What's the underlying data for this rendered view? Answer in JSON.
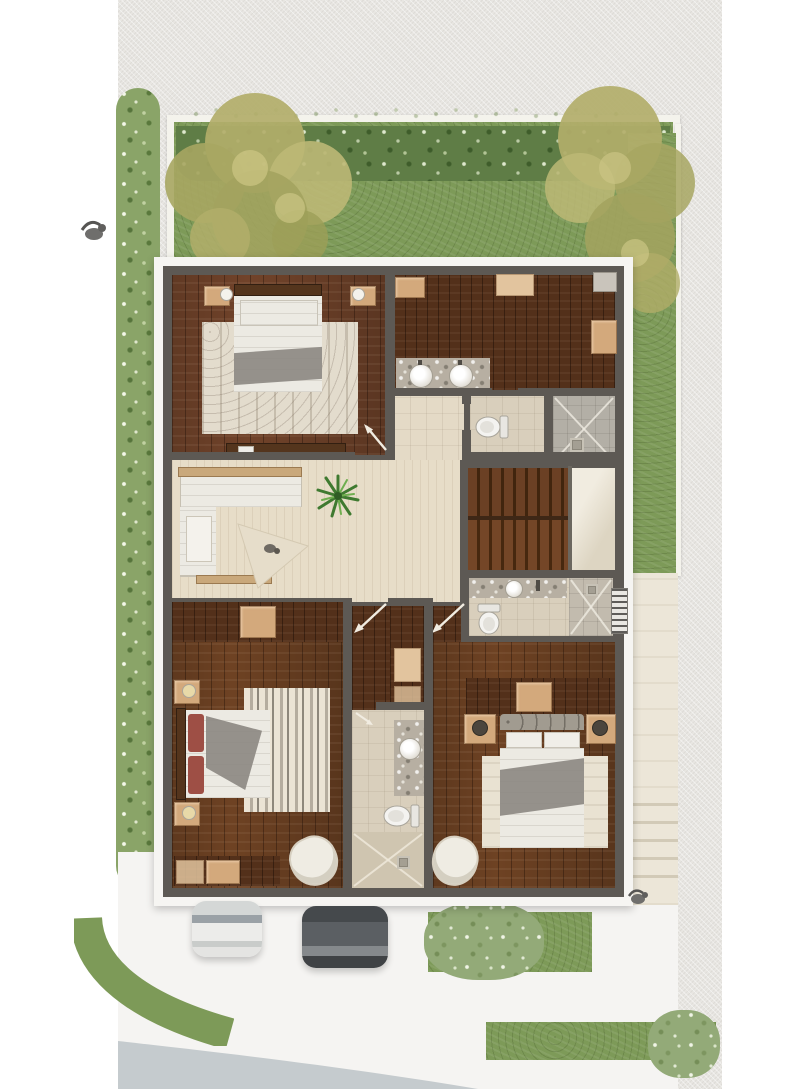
{
  "scene_type": "architectural-floor-plan-render-top-view",
  "visible_text": [],
  "colors": {
    "page_bg": "#ffffff",
    "ground": "#e8e6e2",
    "sidewalk": "#f5f4f2",
    "street": "#c5cbce",
    "lawn": "#7d9a58",
    "shrub_dark": "#5f7d46",
    "shrub_light": "#93aa78",
    "tree_olive": "#b1ad6c",
    "tree_olive_light": "#cdc685",
    "hedge": "#8aa468",
    "fence_white": "#f4f3ec",
    "wall_dark": "#5d5954",
    "wall_white": "#f6f5f2",
    "wood_dark": "#53301a",
    "wood_mid": "#6e4223",
    "wood_red": "#71432a",
    "cream_floor": "#e7ddc8",
    "cream_hall": "#e4dac6",
    "tile_beige": "#d9cfbc",
    "tile_gray": "#b3afa6",
    "marble": "#b7afa2",
    "tan_box": "#d3a97c",
    "tan_box_light": "#e2c49e",
    "linen_white": "#eceae3",
    "linen_gray": "#8d8983",
    "pillow_red": "#9e4f45",
    "rug_cream": "#e3dccd",
    "stair_tread": "#744627",
    "stair_gap": "#47280f",
    "landing": "#ddd5c2",
    "walkway": "#ece6d8",
    "headboard_gray": "#a19b90",
    "car_white": "#e4e4e2",
    "car_white_glass": "#9aa1a6",
    "car_dark": "#5b5f63",
    "car_dark_glass": "#43474b",
    "plant_green": "#3f7a30",
    "arrow_white": "#f1ece1",
    "bird_gray": "#6f6e6c",
    "louver_white": "#e9e7e2"
  },
  "inventory": {
    "outdoor": [
      "back-garden-lawn",
      "garden-shrub-row",
      "olive-tree-left",
      "olive-tree-right",
      "side-hedge",
      "side-yard-strip",
      "side-walkway",
      "exterior-steps",
      "driveway",
      "white-car",
      "dark-car",
      "front-lawn-curve",
      "front-lawn-strips",
      "street",
      "bird-left",
      "bird-right"
    ],
    "rooms": [
      "master-bedroom",
      "walk-in-closet",
      "double-sink-vanity",
      "bathroom-top",
      "shower-top",
      "hallway",
      "living-area",
      "staircase",
      "stair-landing",
      "bathroom-understairs",
      "shower-understairs",
      "corridor",
      "linen-closet",
      "bedroom-left",
      "bathroom-middle",
      "shower-middle",
      "bedroom-right"
    ],
    "furniture": [
      "master-bed",
      "master-rug",
      "nightstands",
      "sofa-sectional",
      "plant",
      "triangular-rug",
      "pet-dog",
      "wardrobes",
      "bed-left",
      "striped-rug",
      "armchairs",
      "bed-right",
      "toilets",
      "sinks",
      "door-swing-arrows"
    ]
  }
}
